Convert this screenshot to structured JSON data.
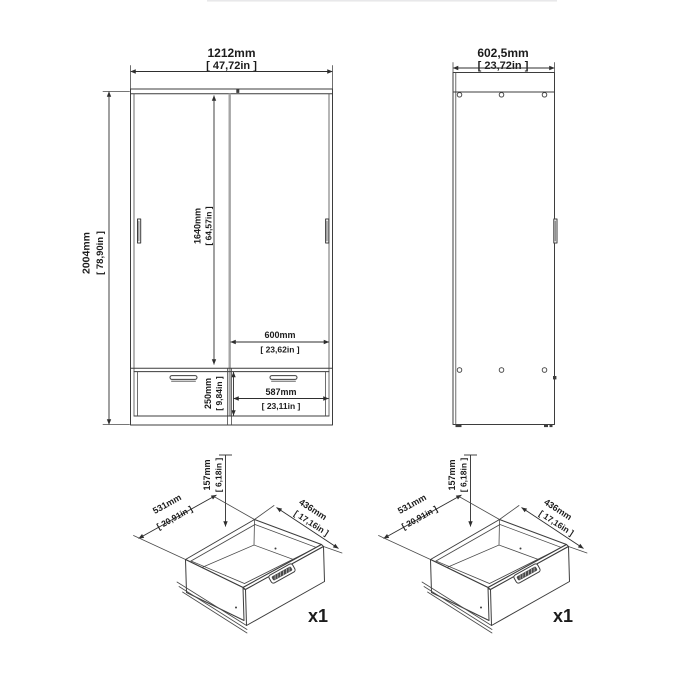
{
  "drawing": {
    "background": "#ffffff",
    "line_color": "#3d3d3d",
    "door_gap_color": "#a5a5a5"
  },
  "front_view": {
    "overall_width_mm": "1212mm",
    "overall_width_in": "[ 47,72in ]",
    "overall_height_mm": "2004mm",
    "overall_height_in": "[ 78,90in ]",
    "door_height_mm": "1640mm",
    "door_height_in": "[ 64,57in ]",
    "door_width_mm": "600mm",
    "door_width_in": "[ 23,62in ]",
    "drawer_front_height_mm": "250mm",
    "drawer_front_height_in": "[ 9,84in ]",
    "drawer_front_width_mm": "587mm",
    "drawer_front_width_in": "[ 23,11in ]"
  },
  "side_view": {
    "depth_mm": "602,5mm",
    "depth_in": "[ 23,72in ]"
  },
  "drawer_left": {
    "width_mm": "531mm",
    "width_in": "[ 20,91in ]",
    "height_mm": "157mm",
    "height_in": "[ 6,18in ]",
    "depth_mm": "436mm",
    "depth_in": "[ 17,16in ]",
    "quantity": "x1"
  },
  "drawer_right": {
    "width_mm": "531mm",
    "width_in": "[ 20,91in ]",
    "height_mm": "157mm",
    "height_in": "[ 6,18in ]",
    "depth_mm": "436mm",
    "depth_in": "[ 17,16in ]",
    "quantity": "x1"
  }
}
